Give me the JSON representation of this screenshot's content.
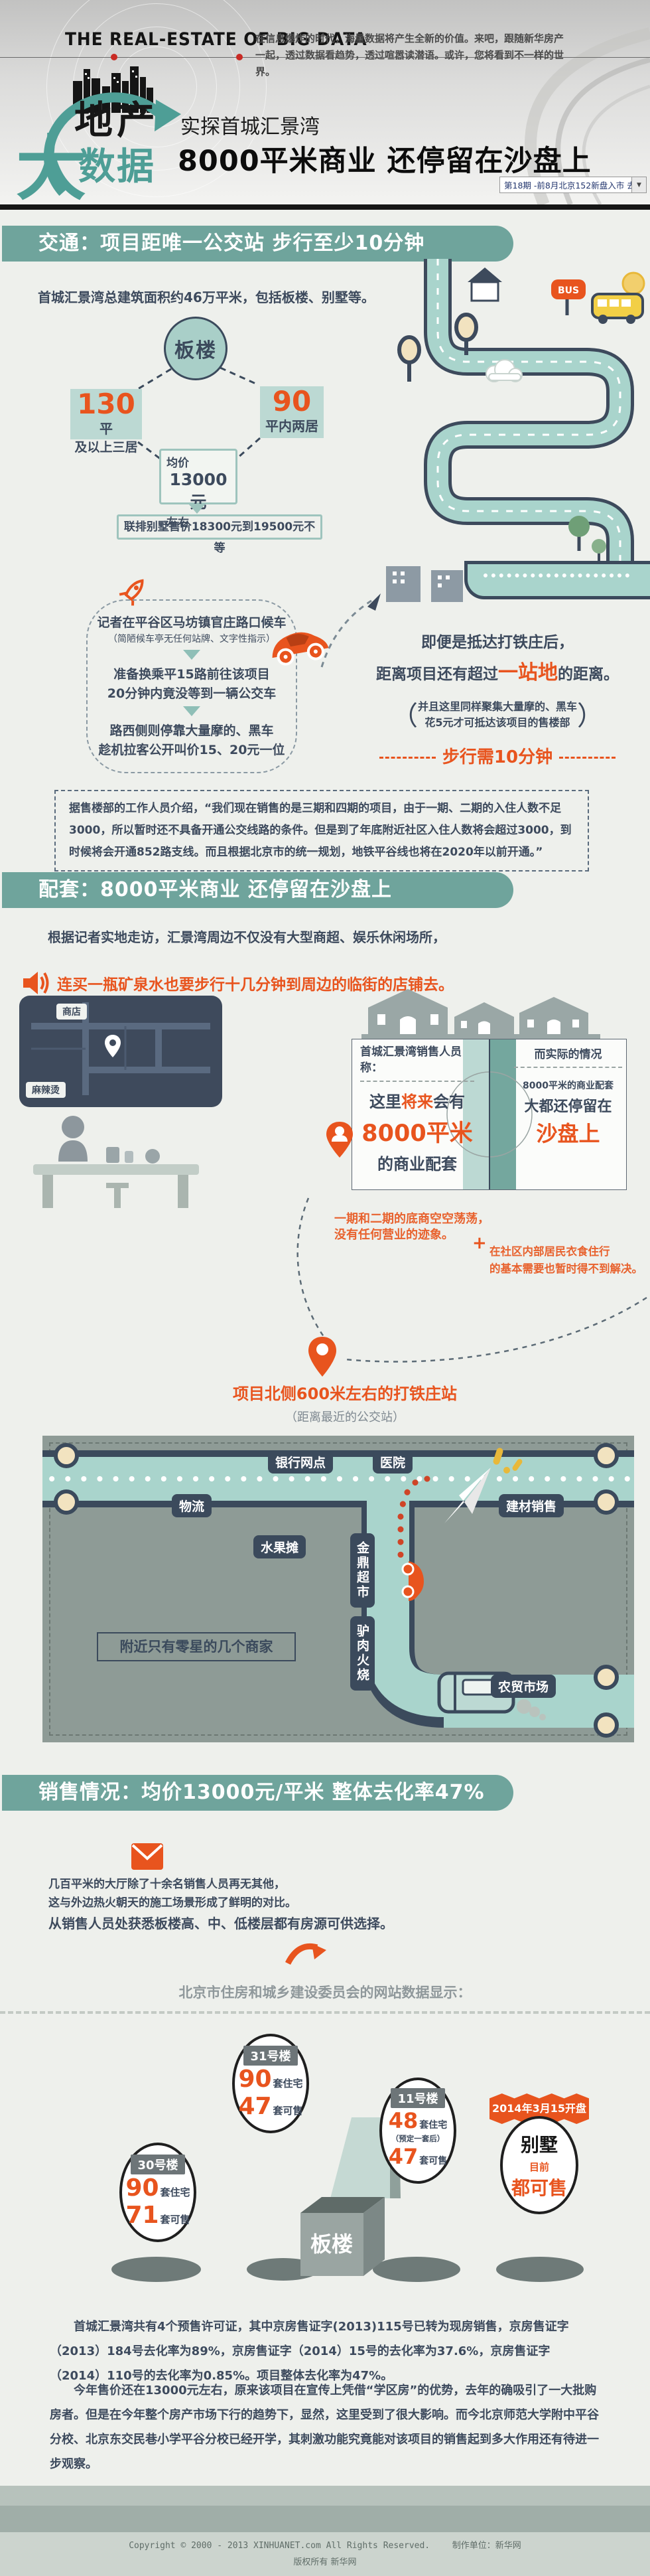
{
  "colors": {
    "teal_bar": "#6fa49c",
    "logo_teal": "#4e9e96",
    "accent_orange": "#e8541e",
    "dark_slate": "#3d4a5d",
    "map_panel": "#8e9b96",
    "road_teal": "#a9d4cc",
    "pill_slate": "#3b4a5c"
  },
  "header": {
    "brand": "THE  REAL-ESTATE OF BIG DATA",
    "intro": "在信息爆炸的时代，海量数据将产生全新的价值。来吧，跟随新华房产一起，透过数据看趋势，透过喧嚣读潜语。或许，您将看到不一样的世界。",
    "logo": {
      "dichan": "地产",
      "da": "大",
      "shuju": "数据"
    },
    "kicker": "实探首城汇景湾",
    "title": "8000平米商业 还停留在沙盘上",
    "issue": {
      "label": "第18期 -前8月北京152新盘入市 去化",
      "arrow": "▼"
    }
  },
  "s1": {
    "heading": "交通：项目距唯一公交站 步行至少10分钟",
    "intro": "首城汇景湾总建筑面积约46万平米，包括板楼、别墅等。",
    "bus_sign": "BUS",
    "diagram": {
      "node": "板楼",
      "left_num": "130",
      "left_unit": "平",
      "left_sub": "及以上三居",
      "right_num": "90",
      "right_sub": "平内两居",
      "price_top": "均价",
      "price_value": "13000元",
      "price_bottom": "左右",
      "villa_note": "联排别墅售价18300元到19500元不等"
    },
    "journey": {
      "step1": "记者在平谷区马坊镇官庄路口候车",
      "step1_note": "（简陋候车亭无任何站牌、文字性指示）",
      "step2a": "准备换乘平15路前往该项目",
      "step2b": "20分钟内竟没等到一辆公交车",
      "step3a": "路西侧则停靠大量摩的、黑车",
      "step3b": "趁机拉客公开叫价15、20元一位"
    },
    "arrival": {
      "line1": "即便是抵达打铁庄后，",
      "line2_pre": "距离项目还有超过",
      "line2_em": "一站地",
      "line2_post": "的距离。",
      "paren_open": "（",
      "paren_close": "）",
      "note1": "并且这里同样聚集大量摩的、黑车",
      "note2": "花5元才可抵达该项目的售楼部",
      "walk": "步行需10分钟"
    },
    "quote": "据售楼部的工作人员介绍，“我们现在销售的是三期和四期的项目，由于一期、二期的入住人数不足3000，所以暂时还不具备开通公交线路的条件。但是到了年底附近社区入住人数将会超过3000，到时候将会开通852路支线。而且根据北京市的统一规划，地铁平谷线也将在2020年以前开通。”"
  },
  "s2": {
    "heading": "配套：8000平米商业 还停留在沙盘上",
    "intro": "根据记者实地走访，汇景湾周边不仅没有大型商超、娱乐休闲场所，",
    "highlight": "连买一瓶矿泉水也要步行十几分钟到周边的临街的店铺去。",
    "minimap": {
      "shop": "商店",
      "stall": "麻辣烫"
    },
    "compare": {
      "left_title": "首城汇景湾销售人员称：",
      "left_pre": "这里",
      "left_em": "将来",
      "left_mid": "会有",
      "left_big": "8000平米",
      "left_post": "的商业配套",
      "right_title": "而实际的情况",
      "right_line1": "8000平米的商业配套",
      "right_line2": "大都还停留在",
      "right_big": "沙盘上"
    },
    "notes": {
      "empty1": "一期和二期的底商空空荡荡，",
      "empty2": "没有任何营业的迹象。",
      "plus": "+",
      "need1": "在社区内部居民衣食住行",
      "need2": "的基本需要也暂时得不到解决。"
    },
    "station": {
      "title": "项目北侧600米左右的打铁庄站",
      "sub": "（距离最近的公交站）"
    },
    "map": {
      "bank": "银行网点",
      "hospital": "医院",
      "logistics": "物流",
      "materials": "建材销售",
      "fruit": "水果摊",
      "supermarket": "金鼎超市",
      "donkey": "驴肉火烧",
      "farmers": "农贸市场",
      "note": "附近只有零星的几个商家"
    }
  },
  "s3": {
    "heading": "销售情况：均价13000元/平米 整体去化率47%",
    "p1": "几百平米的大厅除了十余名销售人员再无其他，",
    "p2": "这与外边热火朝天的施工场景形成了鲜明的对比。",
    "p3": "从销售人员处获悉板楼高、中、低楼层都有房源可供选择。",
    "source": "北京市住房和城乡建设委员会的网站数据显示：",
    "b31": {
      "name": "31号楼",
      "n1": "90",
      "u1": "套住宅",
      "n2": "47",
      "u2": "套可售"
    },
    "b30": {
      "name": "30号楼",
      "n1": "90",
      "u1": "套住宅",
      "n2": "71",
      "u2": "套可售"
    },
    "b11": {
      "name": "11号楼",
      "n1": "48",
      "u1": "套住宅",
      "note": "（预定一套后）",
      "n2": "47",
      "u2": "套可售"
    },
    "villa": {
      "banner": "2014年3月15开盘",
      "name": "别墅",
      "sub": "目前",
      "status": "都可售"
    },
    "building_label": "板楼",
    "p4": "首城汇景湾共有4个预售许可证，其中京房售证字(2013)115号已转为现房销售，京房售证字（2013）184号去化率为89%，京房售证字（2014）15号的去化率为37.6%，京房售证字（2014）110号的去化率为0.85%。项目整体去化率为47%。",
    "p5": "今年售价还在13000元左右，原来该项目在宣传上凭借“学区房”的优势，去年的确吸引了一大批购房者。但是在今年整个房产市场下行的趋势下，显然，这里受到了很大影响。而今北京师范大学附中平谷分校、北京东交民巷小学平谷分校已经开学，其刺激功能究竟能对该项目的销售起到多大作用还有待进一步观察。"
  },
  "footer": {
    "copyright": "Copyright © 2000 - 2013 XINHUANET.com  All Rights Reserved.",
    "maker": "制作单位：新华网",
    "rights": "版权所有 新华网"
  }
}
